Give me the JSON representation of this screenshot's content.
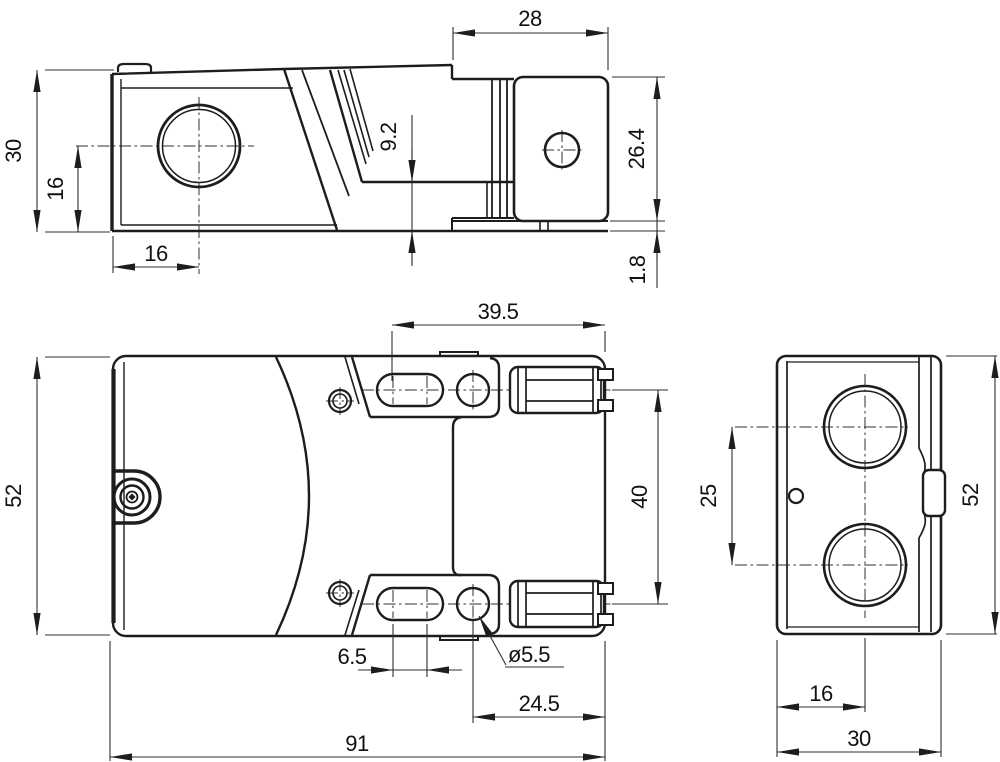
{
  "side_view": {
    "dim_head_width": "28",
    "dim_total_height": "30",
    "dim_hole_center_height": "16",
    "dim_hole_center_x": "16",
    "dim_step_height": "9.2",
    "dim_head_height": "26.4",
    "dim_plate_thickness": "1.8"
  },
  "plan_view": {
    "dim_body_width": "52",
    "dim_flange_length": "39.5",
    "dim_hole_spacing": "40",
    "dim_slot_length": "6.5",
    "dim_hole_diameter": "ø5.5",
    "dim_hole_to_end": "24.5",
    "dim_total_length": "91"
  },
  "end_view": {
    "dim_gland_spacing": "25",
    "dim_height": "52",
    "dim_gland_center_x": "16",
    "dim_width": "30"
  },
  "colors": {
    "line": "#1d1d1b",
    "background": "#ffffff"
  }
}
